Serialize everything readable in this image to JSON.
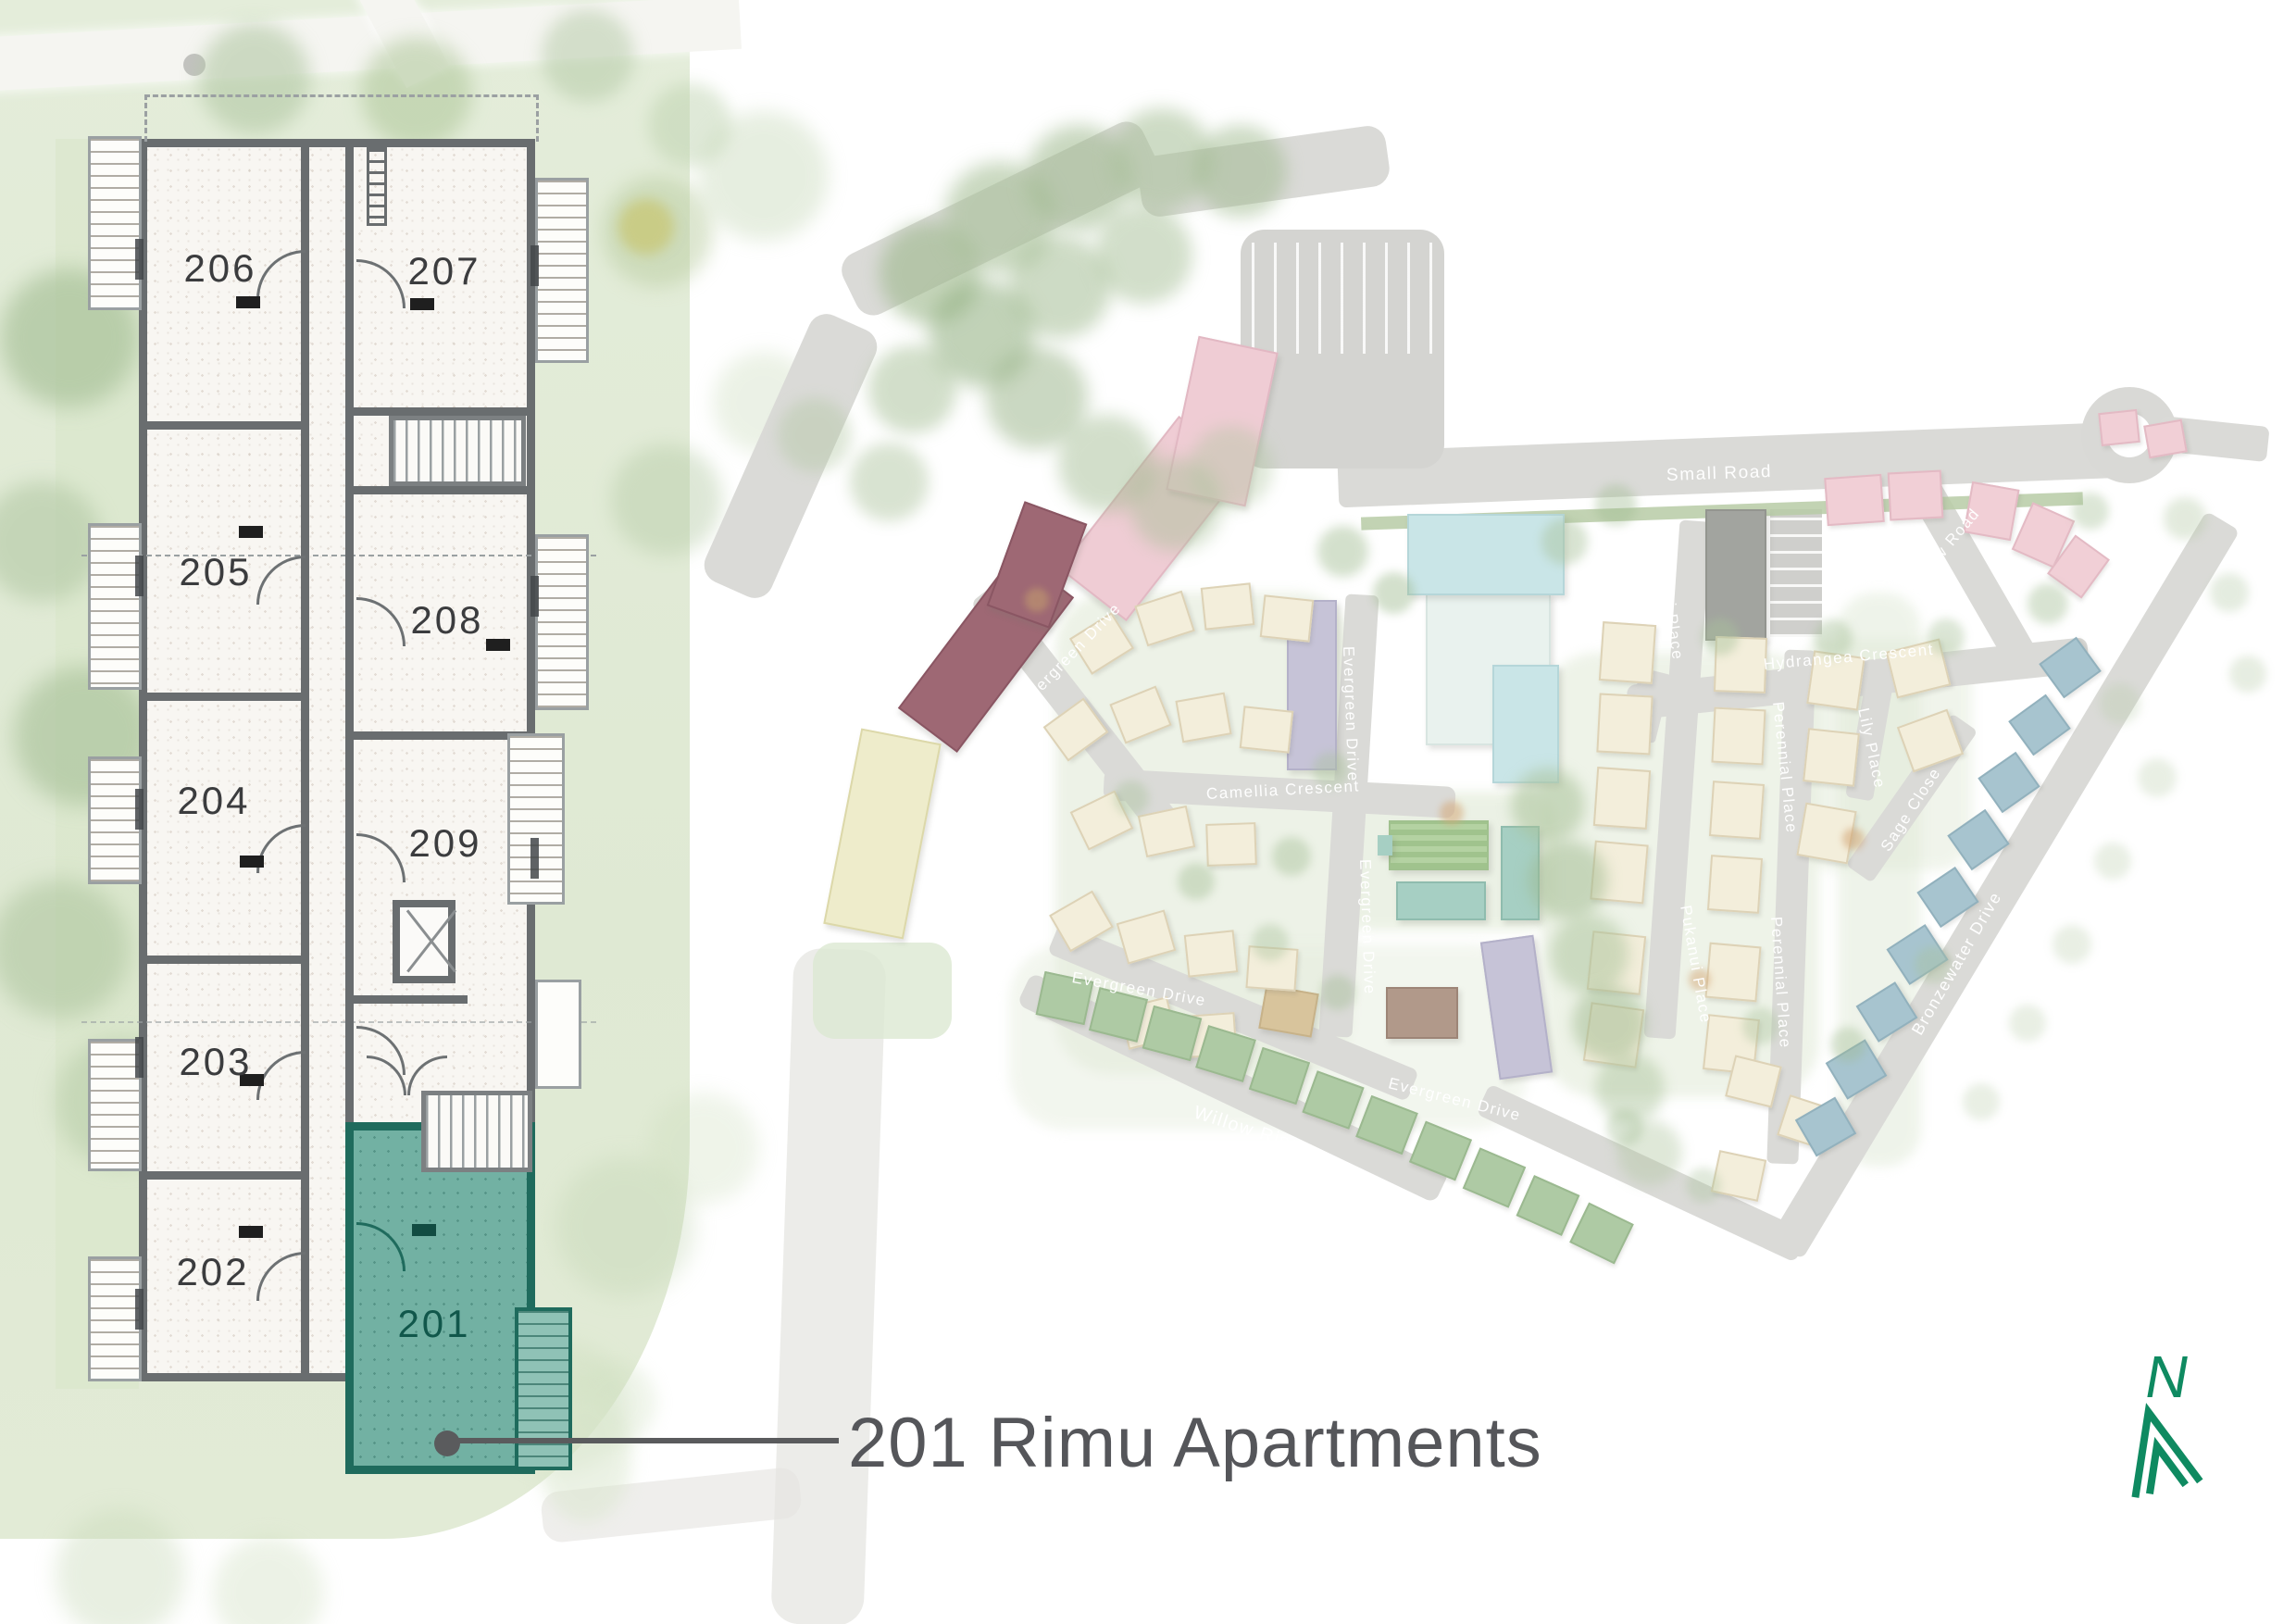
{
  "floorplan": {
    "units": [
      {
        "id": "206",
        "label": "206",
        "highlighted": false
      },
      {
        "id": "207",
        "label": "207",
        "highlighted": false
      },
      {
        "id": "205",
        "label": "205",
        "highlighted": false
      },
      {
        "id": "208",
        "label": "208",
        "highlighted": false
      },
      {
        "id": "204",
        "label": "204",
        "highlighted": false
      },
      {
        "id": "209",
        "label": "209",
        "highlighted": false
      },
      {
        "id": "203",
        "label": "203",
        "highlighted": false
      },
      {
        "id": "202",
        "label": "202",
        "highlighted": false
      },
      {
        "id": "201",
        "label": "201",
        "highlighted": true
      }
    ],
    "highlight_color": "#72b1a3",
    "wall_color": "#696d6f"
  },
  "callout": {
    "label": "201 Rimu Apartments",
    "color": "#55565a"
  },
  "siteplan": {
    "road_labels": [
      {
        "id": "small-road",
        "label": "Small Road"
      },
      {
        "id": "new-road",
        "label": "New Road"
      },
      {
        "id": "hydrangea-crescent",
        "label": "Hydrangea Crescent"
      },
      {
        "id": "pukanui-place-upper",
        "label": "Pukanui Place"
      },
      {
        "id": "pukanui-place-lower",
        "label": "Pukanui Place"
      },
      {
        "id": "perennial-place-upper",
        "label": "Perennial Place"
      },
      {
        "id": "perennial-place-lower",
        "label": "Perennial Place"
      },
      {
        "id": "lily-place",
        "label": "Lily Place"
      },
      {
        "id": "sage-close",
        "label": "Sage Close"
      },
      {
        "id": "bronzewater-drive",
        "label": "Bronzewater Drive"
      },
      {
        "id": "camellia-crescent",
        "label": "Camellia Crescent"
      },
      {
        "id": "evergreen-drive-northwest",
        "label": "Evergreen Drive"
      },
      {
        "id": "evergreen-drive-central",
        "label": "Evergreen Drive"
      },
      {
        "id": "evergreen-drive-south-central",
        "label": "Evergreen Drive"
      },
      {
        "id": "evergreen-drive-southeast",
        "label": "Evergreen Drive"
      },
      {
        "id": "evergreen-drive-southwest",
        "label": "Evergreen Drive"
      },
      {
        "id": "willow-rise",
        "label": "Willow Rise"
      }
    ]
  },
  "north_arrow": {
    "label": "N",
    "color": "#0f8a61"
  }
}
